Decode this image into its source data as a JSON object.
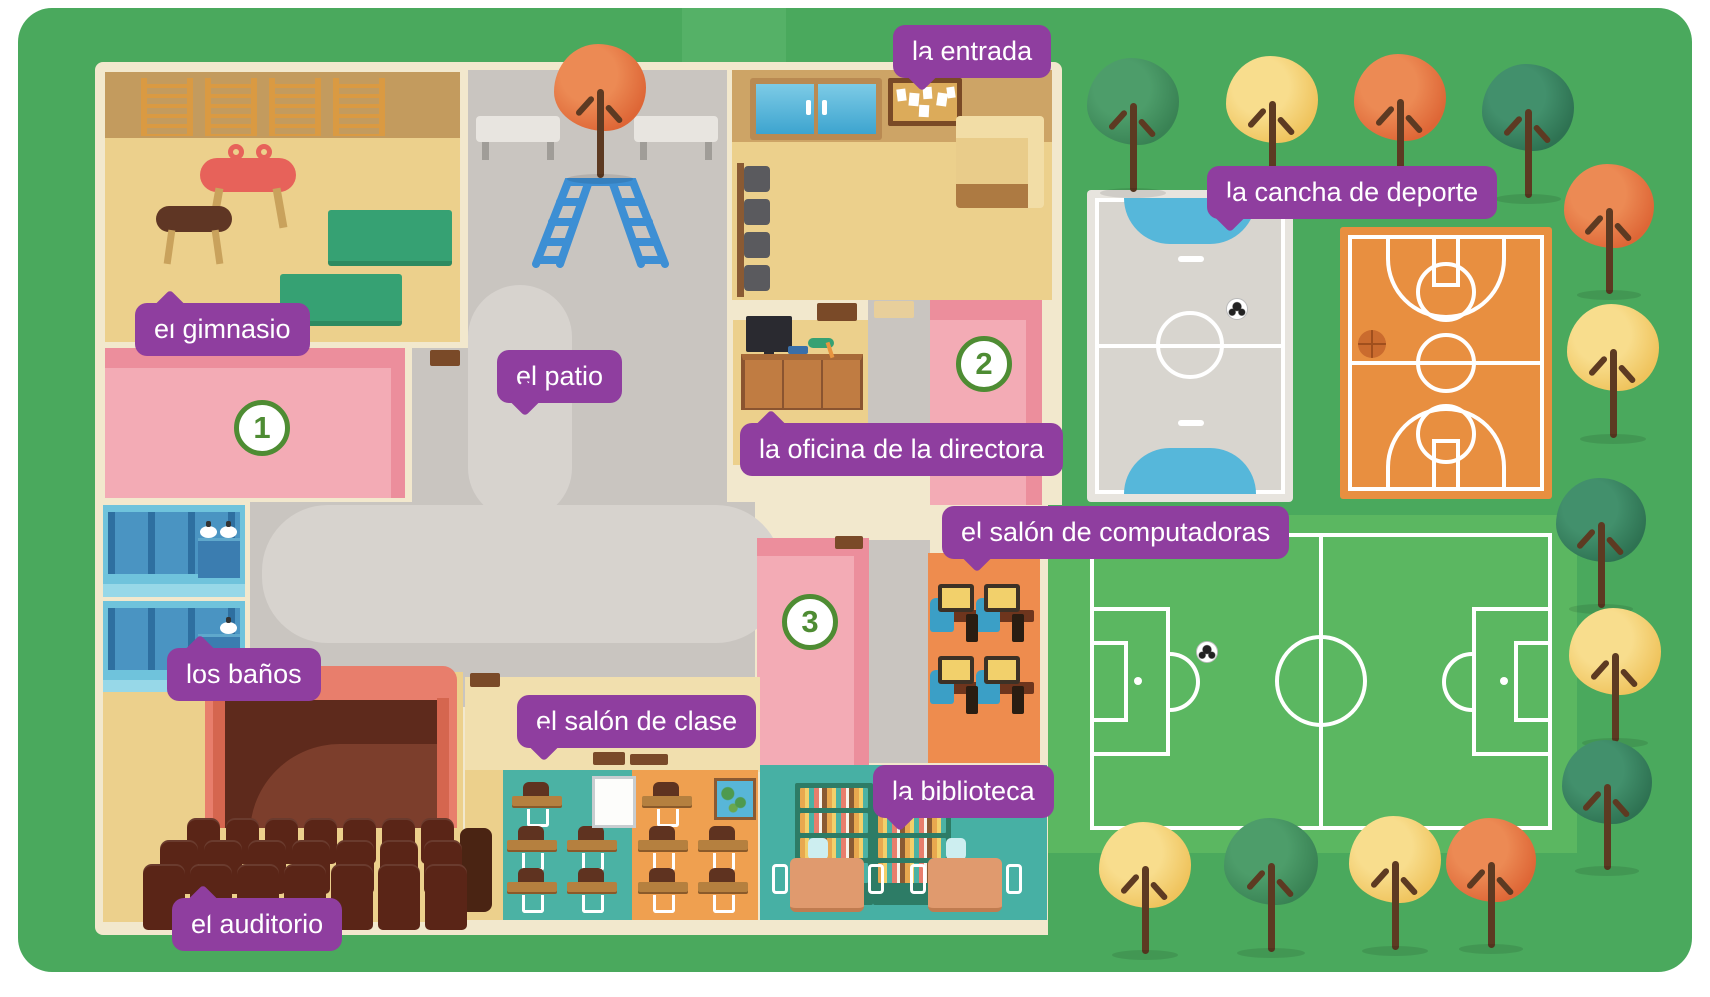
{
  "map": {
    "description": "Illustrated top-down map of a school with Spanish vocabulary labels",
    "labels": {
      "entrada": "la entrada",
      "gimnasio": "el gimnasio",
      "patio": "el patio",
      "oficina": "la oficina de la directora",
      "cancha": "la cancha de deporte",
      "computadoras": "el salón de computadoras",
      "banos": "los baños",
      "salon_clase": "el salón de clase",
      "biblioteca": "la biblioteca",
      "auditorio": "el auditorio"
    },
    "markers": {
      "m1": "1",
      "m2": "2",
      "m3": "3"
    },
    "colors": {
      "label_purple": "#8f3e9f",
      "marker_green": "#4e8c33",
      "grass_green": "#4aa95d",
      "soccer_field_green": "#5bb761",
      "building_cream": "#f2e8cd",
      "floor_tan": "#ecd08c",
      "wall_tan": "#cda466",
      "room_pink_dark": "#ec8e9c",
      "room_pink_light": "#f3abb5",
      "patio_gray": "#c9c5c0",
      "patio_path_gray": "#d7d3ce",
      "futsal_court_gray": "#d8d5cf",
      "goal_area_blue": "#56b7da",
      "basketball_court_orange": "#e88f40",
      "bathroom_blue": "#6fc3dc",
      "classroom_teal": "#4bb2a4",
      "classroom_orange": "#efa050",
      "computer_room_orange": "#ee8c4e",
      "library_teal": "#47b0a4",
      "auditorium_seat_brown": "#5a2517",
      "stage_coral": "#e87e6c"
    }
  }
}
